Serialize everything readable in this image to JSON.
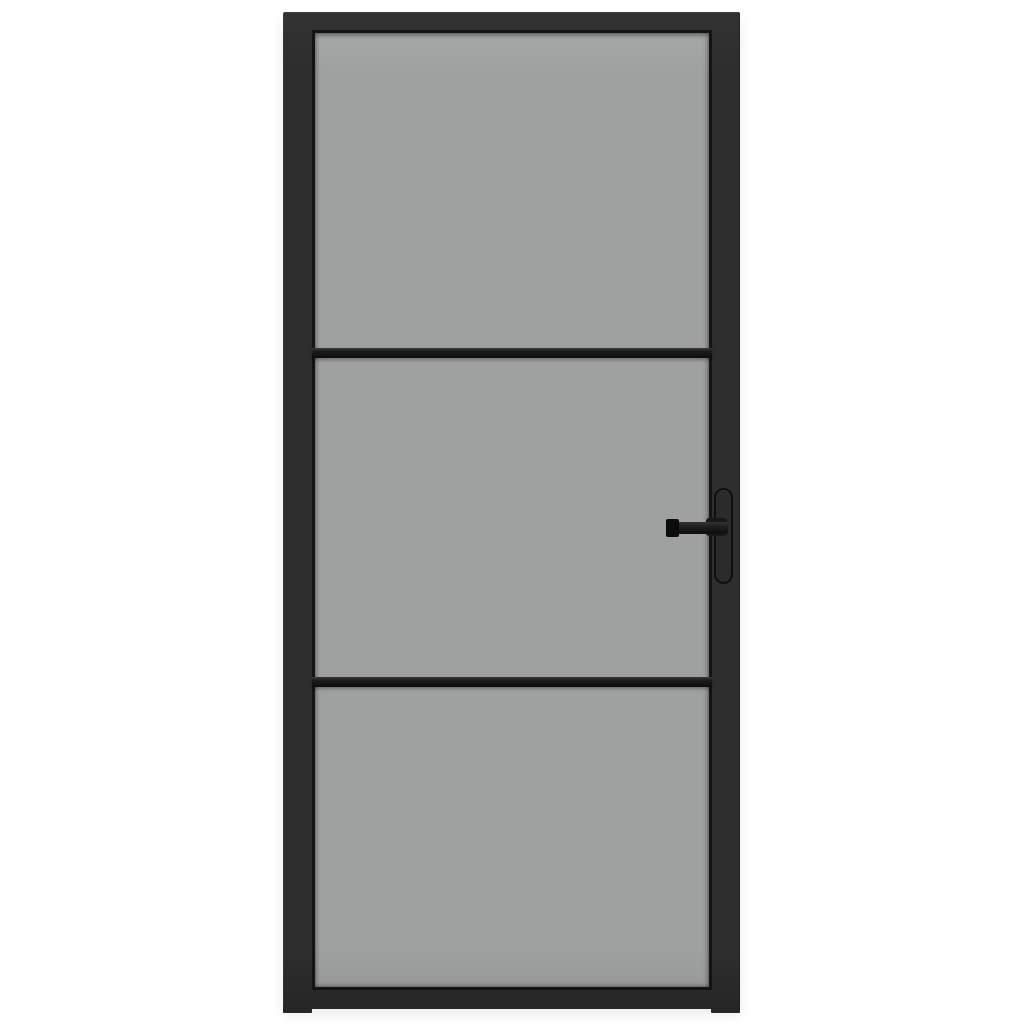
{
  "scene": {
    "type": "product-photo",
    "description": "Front view of a black-framed interior door with three smoked grey glass panels separated by two horizontal black glazing bars, and a black lever handle on a vertical backplate at the right side, photographed on a plain white background."
  },
  "colors": {
    "background": "#ffffff",
    "frame": "#2e2e2f",
    "frame-dark": "#262627",
    "bead": "#141414",
    "glass": "#9fa0a0",
    "glass-light": "#a6a7a7",
    "bar": "#161616",
    "bar-top": "#3a3a3a",
    "handle": "#0c0c0c",
    "plate": "#2b2b2b",
    "plate-outline": "#0f0f0f"
  },
  "door": {
    "panel_count": 3,
    "glazing_bar_count": 2,
    "handle_side": "right",
    "labels": {
      "door": "Black interior door with smoked glass",
      "frame": "Black door frame",
      "glazing": "Smoked grey glass",
      "panel_top": "Top glass panel",
      "panel_middle": "Middle glass panel",
      "panel_bottom": "Bottom glass panel",
      "bar_upper": "Upper glazing bar",
      "bar_lower": "Lower glazing bar",
      "backplate": "Handle backplate",
      "lever": "Lever handle",
      "foot_left": "Left frame foot",
      "foot_right": "Right frame foot"
    }
  }
}
